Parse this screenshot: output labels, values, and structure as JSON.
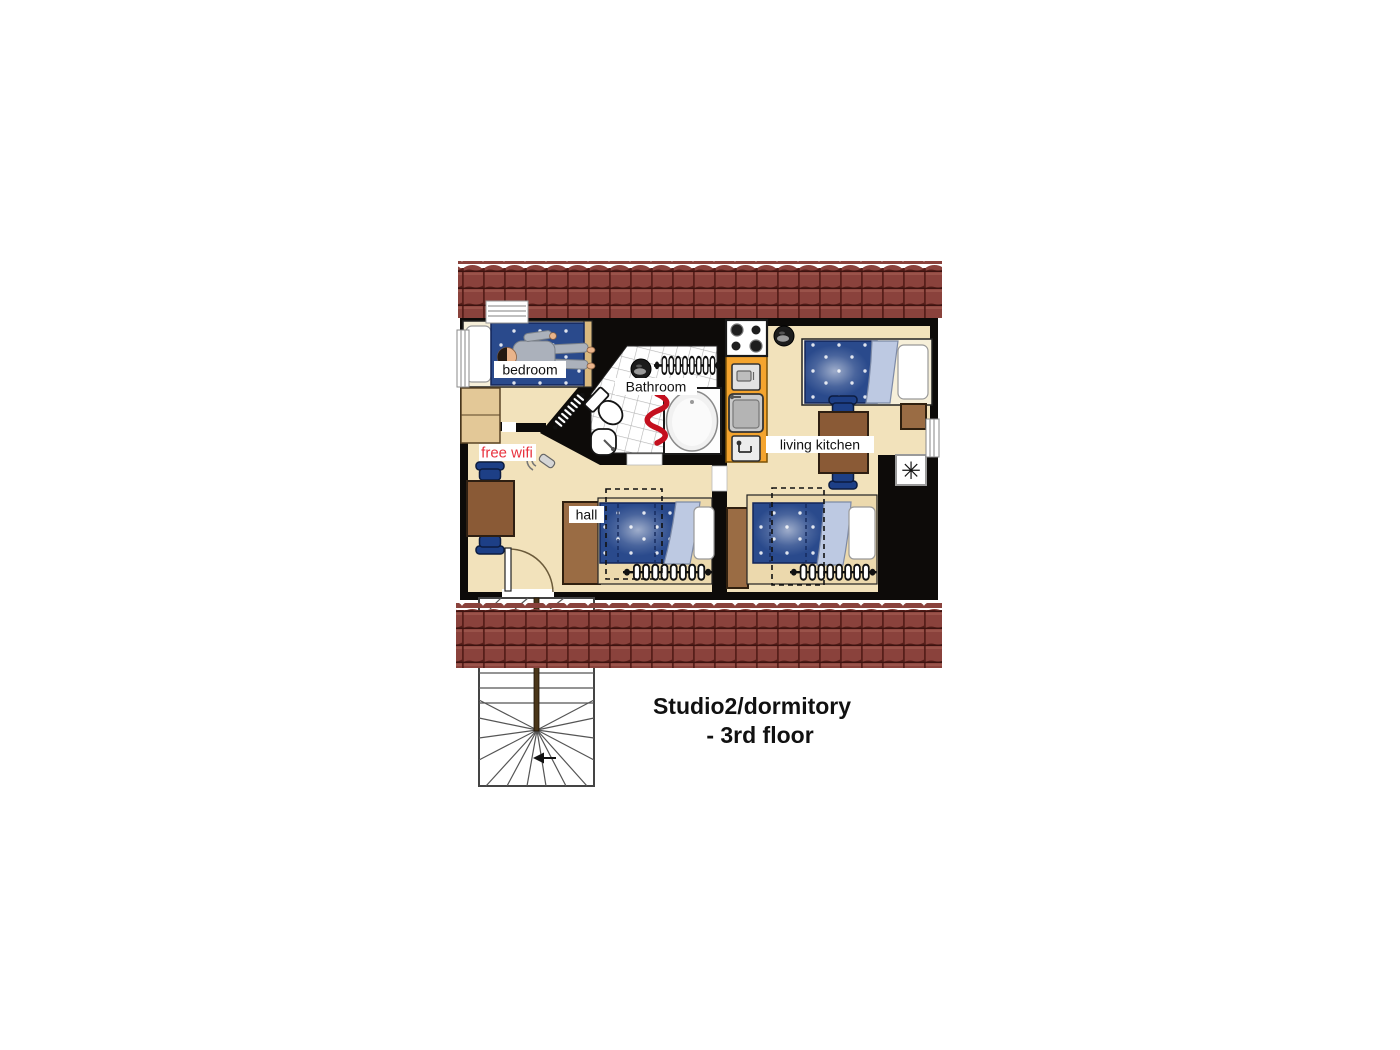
{
  "title": {
    "line1": "Studio2/dormitory",
    "line2": "- 3rd floor"
  },
  "labels": {
    "bedroom": "bedroom",
    "bathroom": "Bathroom",
    "hall": "hall",
    "living_kitchen": "living kitchen",
    "free_wifi": "free wifi"
  },
  "icons": {
    "fridge": "✳",
    "wifi_router": "wifi-router-icon",
    "ceiling_light": "ceiling-light-icon",
    "stair_direction": "left-arrow-icon"
  },
  "colors": {
    "roof": "#8a423c",
    "roof_dark": "#571f1a",
    "roof_light": "#a25a50",
    "wall": "#0d0b09",
    "floor": "#f2e2bb",
    "kitchen": "#f4a42e",
    "bed_blue": "#2a4a8c",
    "blanket": "#bdc9e2",
    "chair_blue": "#1d3f86",
    "wood": "#8a5a36",
    "wood_light": "#e3c897",
    "wood_mid": "#9a6c44",
    "wifi_red": "#e8323e",
    "towel_red": "#c40f1e"
  }
}
